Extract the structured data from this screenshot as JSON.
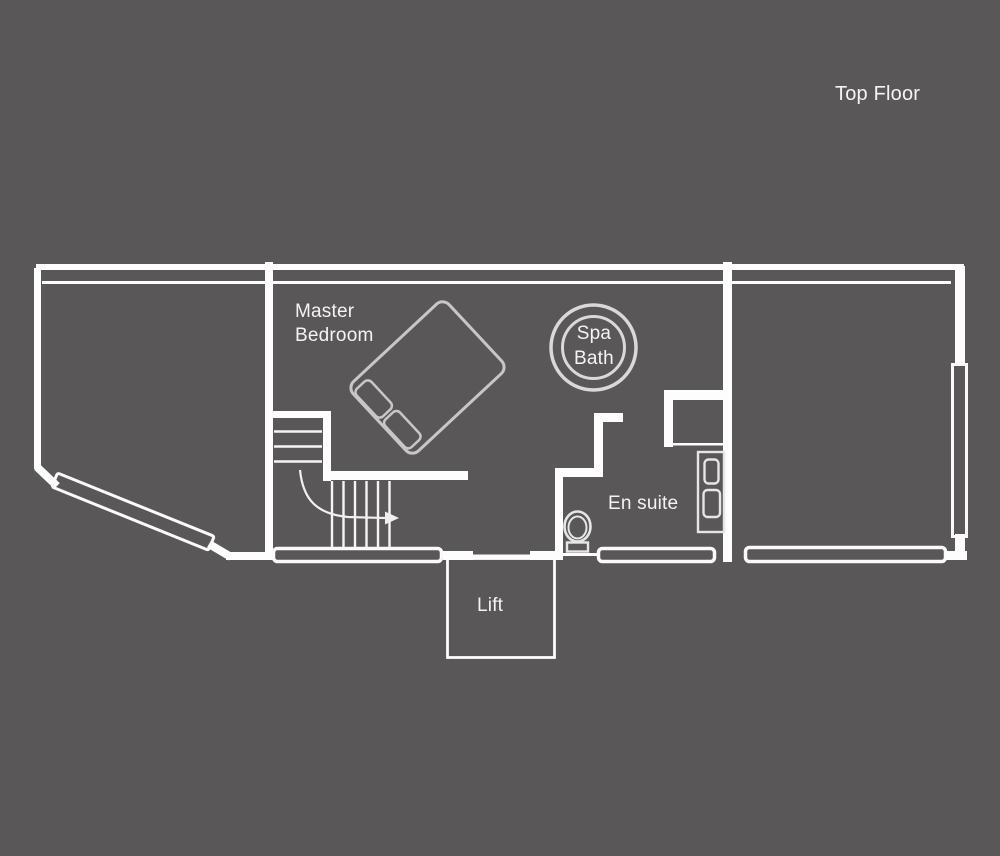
{
  "page": {
    "title": "Top Floor"
  },
  "colors": {
    "background": "#595757",
    "wall": "#fdfdfd",
    "bed_outline": "#c7c7c7",
    "fixture_outline": "#e6e6e6",
    "spa_outline": "#d9d9d9",
    "label_text": "#f4f4f4"
  },
  "floor_plan": {
    "floor_label": "Top Floor",
    "rooms": [
      {
        "id": "master-bedroom",
        "label_line1": "Master",
        "label_line2": "Bedroom"
      },
      {
        "id": "spa-bath",
        "label_line1": "Spa",
        "label_line2": "Bath"
      },
      {
        "id": "en-suite",
        "label": "En suite"
      },
      {
        "id": "lift",
        "label": "Lift"
      }
    ]
  }
}
